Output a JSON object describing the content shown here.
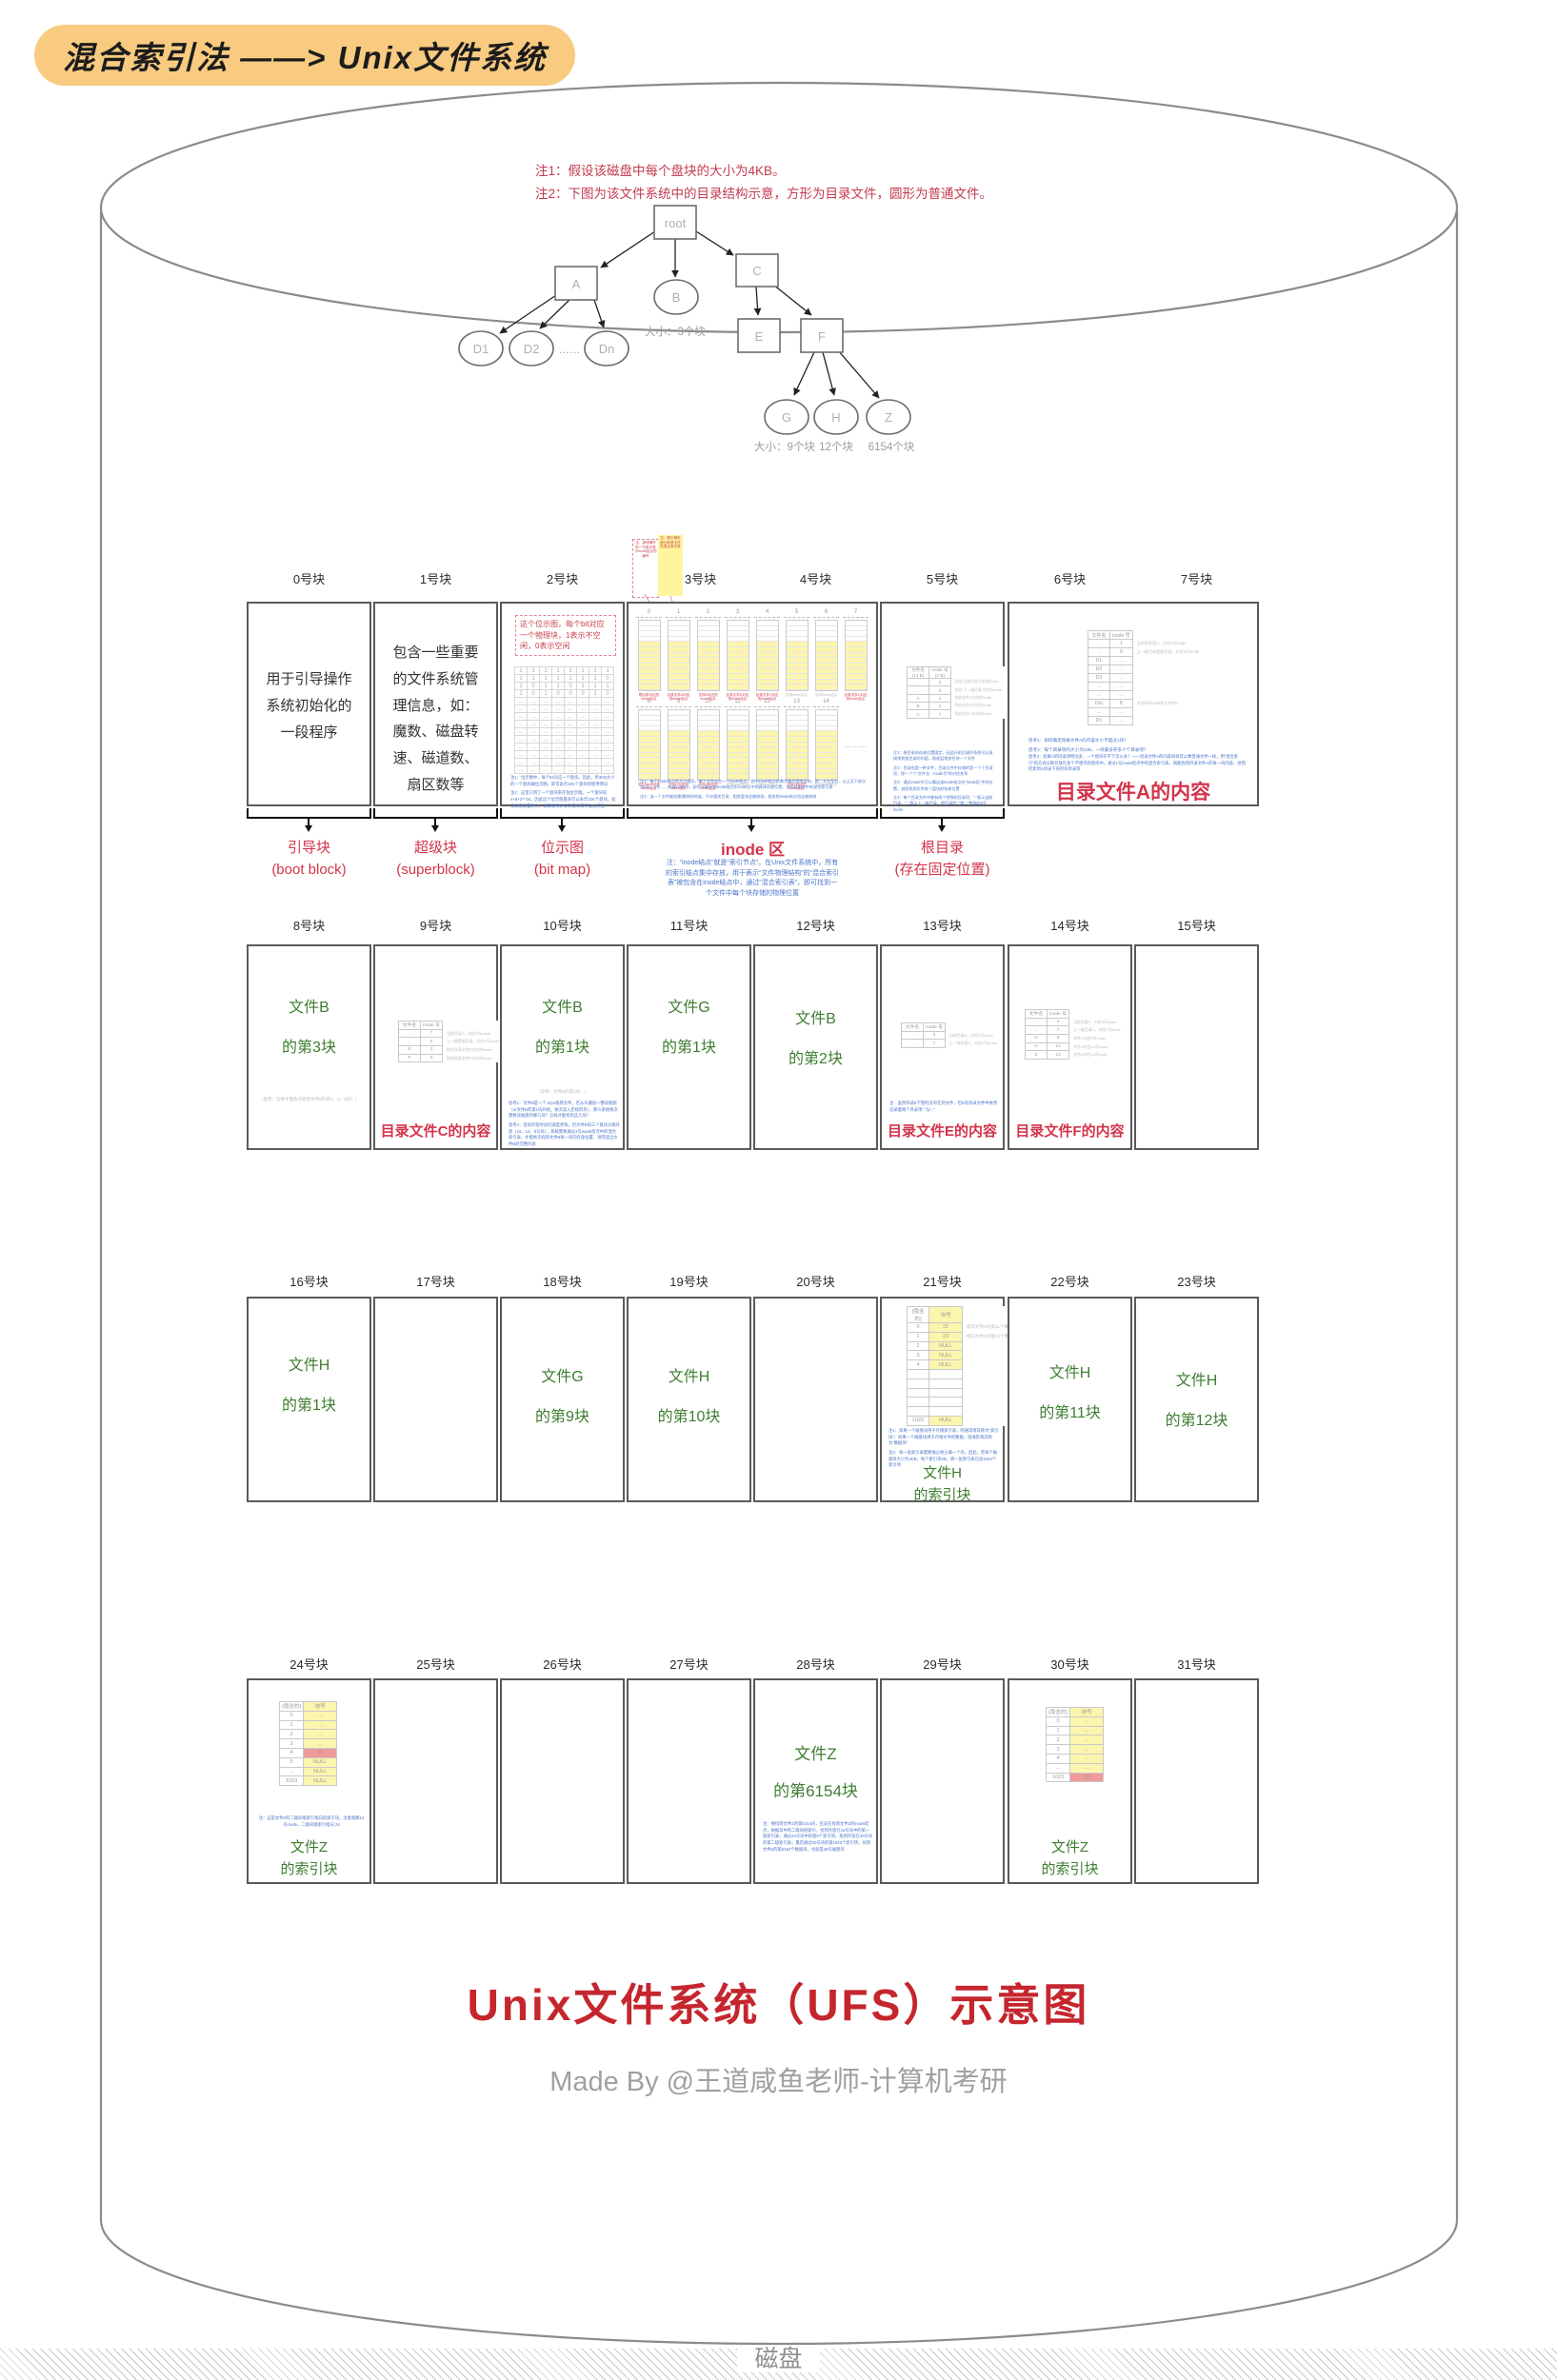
{
  "annotation": {
    "text": "混合索引法 ——> Unix文件系统"
  },
  "notes": {
    "note1": "注1：假设该磁盘中每个盘块的大小为4KB。",
    "note2": "注2：下图为该文件系统中的目录结构示意，方形为目录文件，圆形为普通文件。"
  },
  "tree": {
    "root": "root",
    "a": "A",
    "b": "B",
    "c": "C",
    "d1": "D1",
    "d2": "D2",
    "dots": "……",
    "dn": "Dn",
    "e": "E",
    "f": "F",
    "g": "G",
    "h": "H",
    "z": "Z",
    "b_size": "大小：3个块",
    "g_size": "大小：9个块",
    "h_size": "12个块",
    "z_size": "6154个块"
  },
  "row1": {
    "headers": [
      "0号块",
      "1号块",
      "2号块",
      "3号块",
      "4号块",
      "5号块",
      "6号块",
      "7号块"
    ],
    "boot": {
      "text": "用于引导操作\n系统初始化的\n一段程序",
      "label": "引导块\n(boot block)"
    },
    "superblock": {
      "text": "包含一些重要\n的文件系统管\n理信息，如：\n魔数、磁盘转\n速、磁道数、\n扇区数等",
      "label": "超级块\n(superblock)"
    },
    "bitmap": {
      "callout": "这个位示图，每个bit对应一个物理块，1表示不空闲，0表示空闲",
      "table": {
        "rows": [
          [
            "1",
            "1",
            "1",
            "1",
            "1",
            "1",
            "1",
            "1"
          ],
          [
            "1",
            "1",
            "1",
            "1",
            "1",
            "1",
            "1",
            "0"
          ],
          [
            "1",
            "0",
            "1",
            "1",
            "0",
            "1",
            "1",
            "1"
          ],
          [
            "1",
            "0",
            "1",
            "0",
            "0",
            "0",
            "1",
            "0"
          ],
          [
            "…",
            "…",
            "…",
            "…",
            "…",
            "…",
            "…",
            "…"
          ],
          [
            "…",
            "…",
            "…",
            "…",
            "…",
            "…",
            "…",
            "…"
          ],
          [
            "…",
            "…",
            "…",
            "…",
            "…",
            "…",
            "…",
            "…"
          ],
          [
            "…",
            "…",
            "…",
            "…",
            "…",
            "…",
            "…",
            "…"
          ],
          [
            "…",
            "…",
            "…",
            "…",
            "…",
            "…",
            "…",
            "…"
          ],
          [
            "…",
            "…",
            "…",
            "…",
            "…",
            "…",
            "…",
            "…"
          ],
          [
            "…",
            "…",
            "…",
            "…",
            "…",
            "…",
            "…",
            "…"
          ],
          [
            "…",
            "…",
            "…",
            "…",
            "…",
            "…",
            "…",
            "…"
          ],
          [
            "…",
            "…",
            "…",
            "…",
            "…",
            "…",
            "…",
            "…"
          ],
          [
            "…",
            "…",
            "…",
            "…",
            "…",
            "…",
            "…",
            "…"
          ]
        ]
      },
      "note1": "注1：位示图中，每个bit对应一个盘块。因此，用4KB大小的一个盘块做位示图，即可表示32K个盘块的使用情况",
      "note2": "注2：这里只用了一个盘块来存放位示图。一个盘块有4×8×2¹⁰ bit，因此这个位示图最多可以表示32K个盘块。如果磁盘容量更大，就需要用更多的盘块来存放位示图",
      "label": "位示图\n(bit map)"
    },
    "inode_area": {
      "callout_left": "注：虚线隔开的一行数字表示inode结点的编号",
      "callout_right": "注：图中黄色部分就是文件的混合索引表",
      "strip_a": [
        {
          "no": "0",
          "cap": "根目录对应的\ninode结点"
        },
        {
          "no": "1",
          "cap": "目录文件A对应\n的inode结点"
        },
        {
          "no": "2",
          "cap": "文件B对应的\ninode结点"
        },
        {
          "no": "3",
          "cap": "目录文件E对应\n的inode结点"
        },
        {
          "no": "4",
          "cap": "目录文件F对应\n的inode结点"
        },
        {
          "no": "5",
          "cap": "空闲inode结点"
        },
        {
          "no": "6",
          "cap": "空闲inode结点"
        },
        {
          "no": "7",
          "cap": "目录文件C对应\n的inode结点"
        }
      ],
      "strip_b": [
        {
          "no": "8",
          "cap": "文件Dm对应的\ninode结点"
        },
        {
          "no": "9",
          "cap": "文件G对应的\ninode结点"
        },
        {
          "no": "10",
          "cap": "文件H对应的\ninode结点"
        },
        {
          "no": "11",
          "cap": "空闲inode结点"
        },
        {
          "no": "12",
          "cap": "空闲inode结点"
        },
        {
          "no": "13",
          "cap": "文件Z对应的\ninode结点"
        },
        {
          "no": "14",
          "cap": "空闲inode结点"
        },
        {
          "dots": "………"
        }
      ],
      "note1": "注1：每个inode结点的大小相同，每个文件对应一个inode结点。图中inode结点的数字编号是隐含的，即：从左至右、从上至下依次为0号、1号……知道inode号，即可计算出该inode结点在inode区中的具体存放位置，进而找到其中的混合索引表",
      "note2": "注2：当一个文件被创建/删除的时候，不仅相关目录、相关盘块会被修改，相关的inode结点也会被修改",
      "label": "inode 区",
      "label_note": "注：“inode结点”就是“索引节点”。在Unix文件系统中，所有的索引结点集中存放，用于表示“文件物理结构”的“混合索引表”被包含在inode结点中，通过“混合索引表”，即可找到一个文件中每个块存储的物理位置"
    },
    "rootdir": {
      "table": {
        "head": [
          "文件名\n(14 B)",
          "inode 号\n(2 B)"
        ],
        "rows": [
          [
            ".",
            "0"
          ],
          [
            "..",
            "0"
          ],
          [
            "A",
            "1"
          ],
          [
            "B",
            "2"
          ],
          [
            "C",
            "7"
          ]
        ],
        "notes": [
          "指向“当前目录”对应的inode",
          "指向“上一级目录”对应的inode",
          "指向文件A对应的inode",
          "指向文件B对应的inode",
          "指向文件C对应的inode"
        ]
      },
      "note1": "注1：根目录的存放位置固定，因此开机后操作系统可以直接找到根目录的内容，再逐层找到任何一个文件",
      "note2": "注2：目录也是一种文件，目录文件中存储的是一个个目录项，即一个个“文件名→inode号”的对应关系",
      "note3": "注3：通过inode号可以算出该inode结点在“inode区”中的位置，进而找到文件各个盘块的存放位置",
      "note4": "注4：每个目录文件中都有两个特殊的目录项：“.”表示当前目录，“..”表示上一级目录。根目录的“.”和“..”都指向0号inode",
      "label": "根目录\n(存在固定位置)"
    },
    "dir_a": {
      "table": {
        "head": [
          "文件名",
          "inode 号"
        ],
        "rows": [
          [
            ".",
            "1"
          ],
          [
            "..",
            "0"
          ],
          [
            "D1",
            "…"
          ],
          [
            "D2",
            "…"
          ],
          [
            "D3",
            "…"
          ],
          [
            "…",
            "…"
          ],
          [
            "…",
            "…"
          ],
          [
            "Dm",
            "8"
          ],
          [
            "…",
            "…"
          ],
          [
            "Dn",
            "…"
          ]
        ],
        "notes": [
          "当前目录是A，对应1号inode",
          "上一级目录是根目录，对应0号inode",
          "",
          "",
          "",
          "",
          "",
          "对应8号inode的文件Dm",
          "",
          ""
        ]
      },
      "think1": "思考1：如何确定目录文件A的内容大小不超过1块？",
      "think2": "思考2：每个目录项的大小为16B，一块最多存多少个目录项？",
      "para": "思考3：如果A的目录项特别多，一个盘块存不下怎么办？——目录文件A的内容同样可以像普通文件一样，用“混合索引”的方式分散存放在多个不相邻的盘块中。通过1号inode结点中的混合索引表，就能找到目录文件A的每一块内容，进而检索到A目录下的所有目录项",
      "caption": "目录文件A的内容"
    }
  },
  "row2": {
    "headers": [
      "8号块",
      "9号块",
      "10号块",
      "11号块",
      "12号块",
      "13号块",
      "14号块",
      "15号块"
    ],
    "b8": {
      "caption": "文件B\n的第3块",
      "note": "（思考：怎样才能依次找到文件B的第1、2、3块？）"
    },
    "b9": {
      "table": {
        "head": [
          "文件名",
          "inode 号"
        ],
        "rows": [
          [
            ".",
            "7"
          ],
          [
            "..",
            "0"
          ],
          [
            "E",
            "3"
          ],
          [
            "F",
            "4"
          ]
        ],
        "notes": [
          "当前目录C，对应7号inode",
          "上一级是根目录，对应0号inode",
          "指向目录文件E对应的inode",
          "指向目录文件F对应的inode"
        ]
      },
      "caption": "目录文件C的内容"
    },
    "b10": {
      "caption": "文件B\n的第1块",
      "note": "（思考：文件B的第1块…）",
      "think1": "思考1：文件B是一个.mp4视频文件，若从头播放一整段视频（从文件B的第1块开始，依次读入后续的块），那么系统依次需要读磁盘的哪几块？怎样才能找到这几块？",
      "think2": "思考2：连续存放时访问速度更快，但文件B的三个盘块分散存放（10、12、8号块），系统需要通过2号inode结点中的混合索引表，才能依次找到文件B每一块的存放位置，进而读出文件B的完整内容"
    },
    "b11": {
      "caption": "文件G\n的第1块"
    },
    "b12": {
      "caption": "文件B\n的第2块"
    },
    "b13": {
      "table": {
        "head": [
          "文件名",
          "inode 号"
        ],
        "rows": [
          [
            ".",
            "3"
          ],
          [
            "..",
            "7"
          ]
        ],
        "notes": [
          "当前目录E，对应3号inode",
          "上一级目录C，对应7号inode"
        ]
      },
      "note": "注：虽然目录E下暂时没有任何文件，但E的目录文件中依然记录着两个目录项“.”与“..”",
      "caption": "目录文件E的内容"
    },
    "b14": {
      "table": {
        "head": [
          "文件名",
          "inode 号"
        ],
        "rows": [
          [
            ".",
            "4"
          ],
          [
            "..",
            "7"
          ],
          [
            "G",
            "9"
          ],
          [
            "H",
            "10"
          ],
          [
            "Z",
            "13"
          ]
        ],
        "notes": [
          "当前目录F，对应4号inode",
          "上一级目录C，对应7号inode",
          "文件G对应9号inode",
          "文件H对应10号inode",
          "文件Z对应13号inode"
        ]
      },
      "caption": "目录文件F的内容"
    }
  },
  "row3": {
    "headers": [
      "16号块",
      "17号块",
      "18号块",
      "19号块",
      "20号块",
      "21号块",
      "22号块",
      "23号块"
    ],
    "b16": {
      "caption": "文件H\n的第1块"
    },
    "b18": {
      "caption": "文件G\n的第9块"
    },
    "b19": {
      "caption": "文件H\n的第10块"
    },
    "b21": {
      "table": {
        "head": [
          "(隐含的)",
          "块号"
        ],
        "rows": [
          [
            "0",
            "22"
          ],
          [
            "1",
            "23"
          ],
          [
            "2",
            "NULL"
          ],
          [
            "3",
            "NULL"
          ],
          [
            "4",
            "NULL"
          ],
          [
            "",
            ""
          ],
          [
            "",
            ""
          ],
          [
            "",
            ""
          ],
          [
            "",
            ""
          ],
          [
            "",
            ""
          ],
          [
            "1023",
            "NULL"
          ]
        ],
        "notes": [
          "指向文件H的第11个数据块",
          "指向文件H的第12个数据块"
        ]
      },
      "note1": "注1：如果一个磁盘块用于存储索引表，则通常将其称为“索引块”；如果一个磁盘块用于存储文件的数据，则通常将其称为“数据块”",
      "note2": "注2：每一张索引表需要独占地占满一个块。因此，若每个磁盘块大小为4KB，每个索引项4B，则一张索引表包含1024个索引项",
      "caption": "文件H\n的索引块"
    },
    "b22": {
      "caption": "文件H\n的第11块"
    },
    "b23": {
      "caption": "文件H\n的第12块"
    }
  },
  "row4": {
    "headers": [
      "24号块",
      "25号块",
      "26号块",
      "27号块",
      "28号块",
      "29号块",
      "30号块",
      "31号块"
    ],
    "b24": {
      "table": {
        "head": [
          "(隐含的)",
          "块号"
        ],
        "rows": [
          [
            "0",
            "…"
          ],
          [
            "1",
            "…"
          ],
          [
            "2",
            "…"
          ],
          [
            "3",
            "…"
          ],
          [
            "4",
            "30"
          ],
          [
            "5",
            "NULL"
          ],
          [
            "…",
            "NULL"
          ],
          [
            "1023",
            "NULL"
          ]
        ],
        "red": [
          4
        ]
      },
      "note": "注：这是文件Z的二级间接索引指向的索引块。注意观察13号inode，二级间接索引指向 24",
      "caption": "文件Z\n的索引块"
    },
    "b28": {
      "caption": "文件Z\n的第6154块",
      "note": "注：要找到文件Z的第6154块，应该先找到文件Z的inode结点，根据其中的二级间接索引，找到存放在24号块中的第一级索引表；通过24号块中的第5个索引项，找到存放在30号块的第二级索引表；最后通过30号块的第1023个索引项，找到文件Z的第6154个数据块，也就是28号磁盘块"
    },
    "b30": {
      "table": {
        "head": [
          "(隐含的)",
          "块号"
        ],
        "rows": [
          [
            "0",
            "…"
          ],
          [
            "1",
            "…"
          ],
          [
            "2",
            "…"
          ],
          [
            "3",
            "…"
          ],
          [
            "4",
            "…"
          ],
          [
            "…",
            "…"
          ],
          [
            "1023",
            "28"
          ]
        ],
        "red": [
          6
        ]
      },
      "caption": "文件Z\n的索引块"
    }
  },
  "footer": {
    "title": "Unix文件系统（UFS）示意图",
    "credit": "Made By @王道咸鱼老师-计算机考研",
    "disk": "磁盘"
  }
}
